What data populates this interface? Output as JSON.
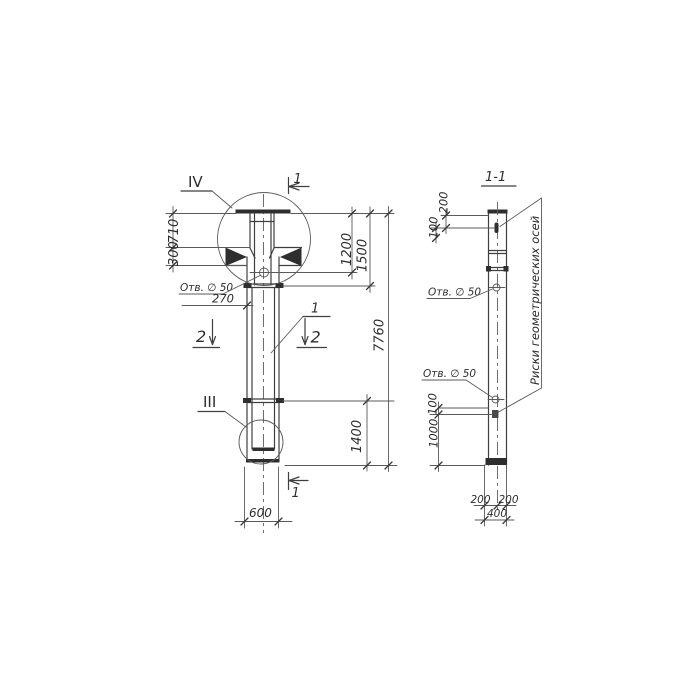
{
  "drawing": {
    "front_view": {
      "detail_top": "IV",
      "detail_bottom": "III",
      "cut_1_top": "1",
      "cut_1_bottom": "1",
      "cut_2_left": "2",
      "cut_2_right": "2",
      "position": "1",
      "hole_label": "Отв. ∅ 50",
      "dim_710": "710",
      "dim_300": "300",
      "dim_270": "270",
      "dim_1200": "1200",
      "dim_1500": "1500",
      "dim_7760": "7760",
      "dim_1400": "1400",
      "dim_600": "600"
    },
    "section_view": {
      "title": "1-1",
      "dim_200_top": "200",
      "dim_100_top": "100",
      "hole_label_top": "Отв. ∅ 50",
      "hole_label_bottom": "Отв. ∅ 50",
      "dim_100_bottom": "100",
      "dim_1000": "1000",
      "dim_200_bottom_left": "200",
      "dim_200_bottom_right": "200",
      "dim_400": "400",
      "axes_note": "Риски геометрических осей"
    }
  }
}
